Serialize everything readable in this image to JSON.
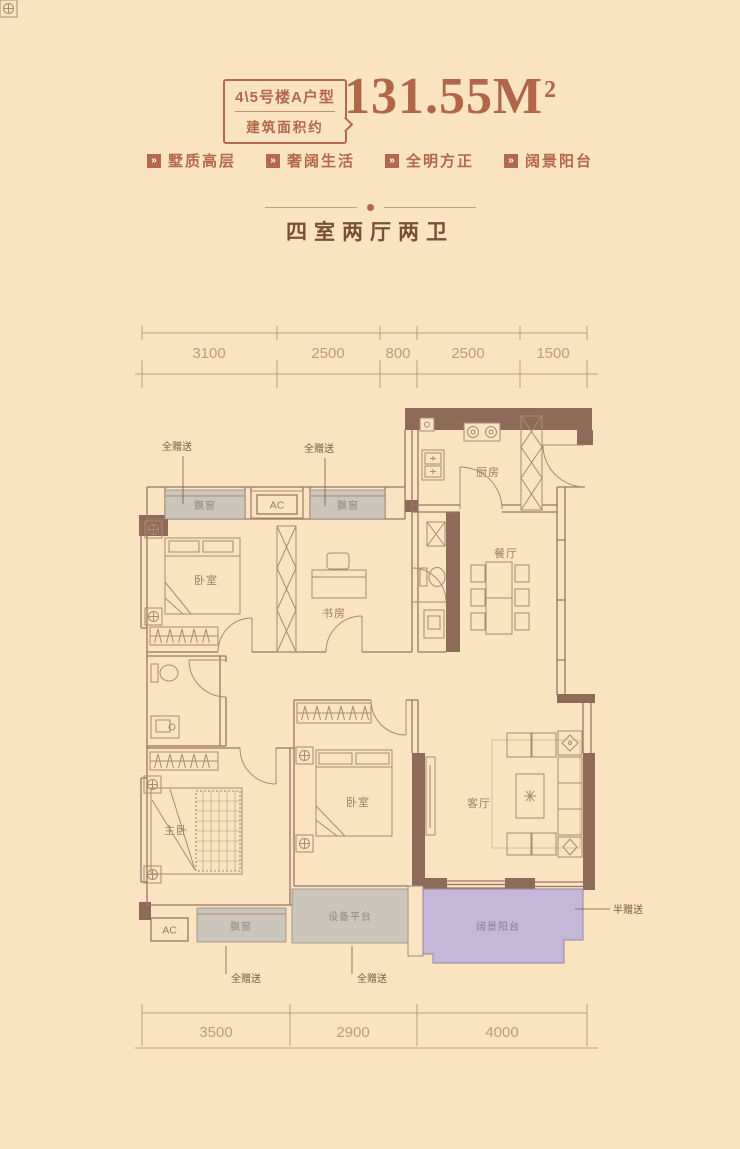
{
  "header": {
    "badge_line1": "4\\5号楼A户型",
    "badge_line2": "建筑面积约",
    "area_value": "131.55M",
    "area_sup": "2"
  },
  "tags": [
    {
      "label": "墅质高层"
    },
    {
      "label": "奢阔生活"
    },
    {
      "label": "全明方正"
    },
    {
      "label": "阔景阳台"
    }
  ],
  "title": "四室两厅两卫",
  "plan": {
    "rooms": {
      "bedroom1": "卧室",
      "study": "书房",
      "kitchen": "厨房",
      "dining": "餐厅",
      "master_bedroom": "主卧",
      "bedroom2": "卧室",
      "living": "客厅"
    },
    "areas": {
      "bay_window": "飘窗",
      "equipment_platform": "设备平台",
      "balcony": "阔景阳台"
    },
    "annotations": {
      "full_gift": "全赠送",
      "half_gift": "半赠送",
      "ac": "AC"
    },
    "dimensions": {
      "top": [
        "3100",
        "2500",
        "800",
        "2500",
        "1500"
      ],
      "bottom": [
        "3500",
        "2900",
        "4000"
      ]
    }
  },
  "colors": {
    "background": "#f9e3c0",
    "accent_copper": "#b4684c",
    "wall_brown": "#8e6a59",
    "bay_gray": "#cbc5bc",
    "balcony_purple": "#c4b7d7",
    "dimension": "#c49b7b"
  }
}
